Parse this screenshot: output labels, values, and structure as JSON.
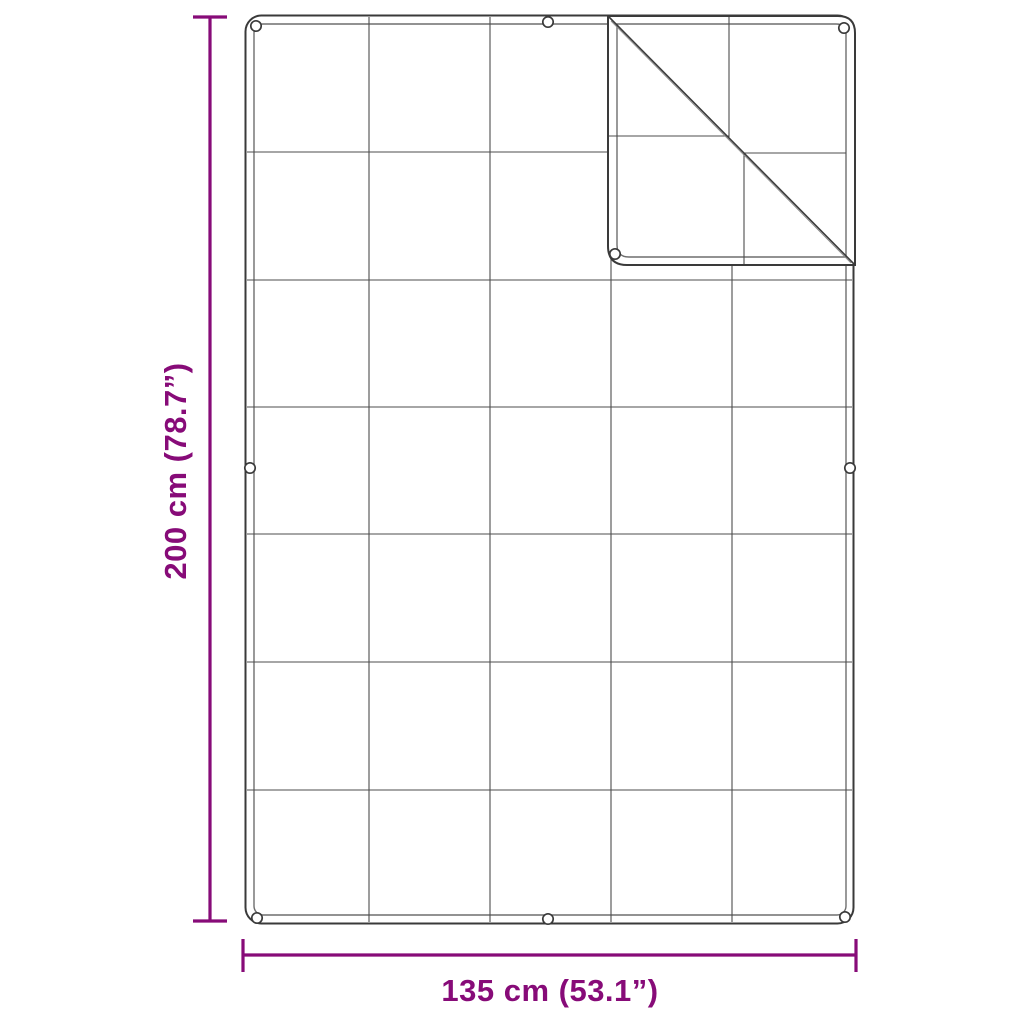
{
  "diagram": {
    "kind": "product-dimension-diagram",
    "subject": "gridded tarp with folded top-right corner and grommets",
    "height_dimension": {
      "label": "200 cm (78.7”)",
      "orientation": "vertical"
    },
    "width_dimension": {
      "label": "135 cm (53.1”)",
      "orientation": "horizontal"
    },
    "colors": {
      "dimension_accent": "#870b78",
      "outline": "#3a3a3a",
      "hem_inner": "#6e6e6e",
      "grid_line": "#4d4d4d",
      "background": "#ffffff"
    },
    "grid": {
      "columns": 5,
      "rows": 7
    },
    "folded_corner": "top-right",
    "grommets": {
      "count": 9,
      "positions": [
        "top-left",
        "top-center",
        "left-middle",
        "bottom-left",
        "bottom-center",
        "bottom-right",
        "right-middle",
        "flap-top-right",
        "flap-bottom-left"
      ]
    }
  }
}
